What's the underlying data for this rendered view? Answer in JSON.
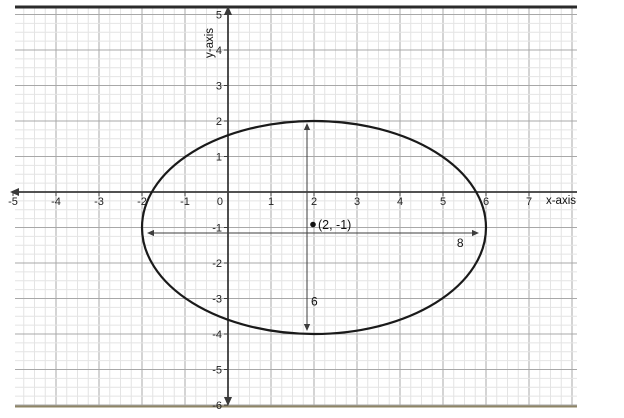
{
  "figure": {
    "xlabel": "x-axis",
    "ylabel": "y-axis"
  },
  "chart_data": {
    "type": "line",
    "shape": "ellipse",
    "title": "",
    "xlabel": "x-axis",
    "ylabel": "y-axis",
    "xlim": [
      -5.1,
      8.1
    ],
    "ylim": [
      -6.2,
      5.2
    ],
    "x_ticks": [
      -5,
      -4,
      -3,
      -2,
      -1,
      0,
      1,
      2,
      3,
      4,
      5,
      6,
      7
    ],
    "y_ticks": [
      -6,
      -5,
      -4,
      -3,
      -2,
      -1,
      1,
      2,
      3,
      4,
      5
    ],
    "grid": {
      "major_step": 1,
      "minor_step": 0.25,
      "visible": true
    },
    "legend": "none",
    "ellipse": {
      "center_x": 2,
      "center_y": -1,
      "semi_axis_horizontal": 4,
      "semi_axis_vertical": 3,
      "horizontal_axis_length": 8,
      "vertical_axis_length": 6
    },
    "annotations": {
      "center_point": {
        "x": 2,
        "y": -1,
        "label": "(2, -1)"
      },
      "horizontal_axis_arrow": {
        "from": [
          -2,
          -1
        ],
        "to": [
          6,
          -1
        ],
        "label": "8"
      },
      "vertical_axis_arrow": {
        "from": [
          2,
          2
        ],
        "to": [
          2,
          -4
        ],
        "label": "6"
      }
    },
    "colors": {
      "curve": "#1a1a1a",
      "axis": "#3a3a3a",
      "major_grid": "#a8a8a8",
      "minor_grid": "#e4e4e4",
      "annotation": "#3d3d3d",
      "text": "#222222",
      "top_border": "#2b2b2b",
      "bottom_border": "#8e8465"
    }
  }
}
